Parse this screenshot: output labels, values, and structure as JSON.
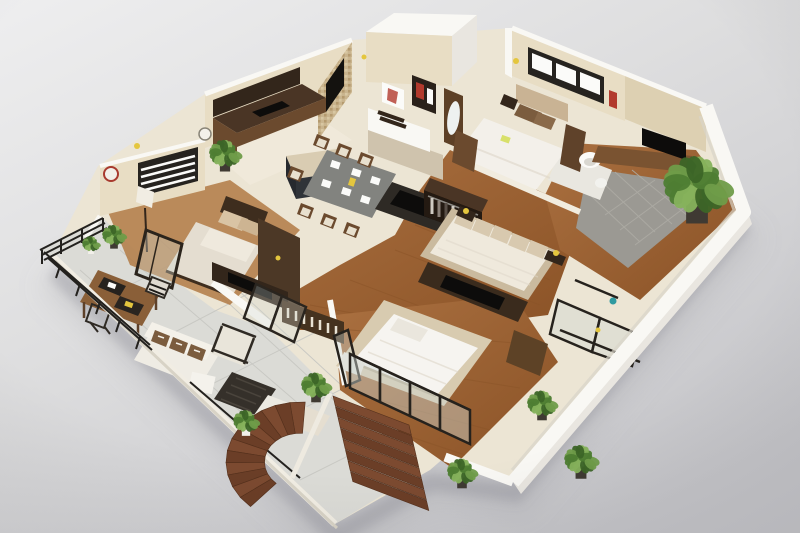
{
  "meta": {
    "title": "3D isometric floor plan rendering",
    "description": "Photorealistic 3D cutaway floor plan of a furnished multi-bedroom apartment viewed from above at an angle, on a neutral gray studio background"
  },
  "palette": {
    "bgLight": "#ededef",
    "bgMid": "#dcdcdf",
    "bgDark": "#c6c6ca",
    "groundShadow": "#8e8e96",
    "wallWhite": "#f9f8f4",
    "wallWhiteFace": "#e9e6e0",
    "wallCream": "#e8ddc4",
    "wallCreamDark": "#ddd0b2",
    "floorCream": "#ece5d4",
    "floorKitchen": "#f0e9da",
    "tileLine": "#d6cfbf",
    "balconyTile": "#dbdbd6",
    "balconyTileLine": "#c7c7c2",
    "grayTile": "#9b9993",
    "grayTileLine": "#adaba4",
    "wood": "#9c6434",
    "woodLight": "#b27a44",
    "woodDark": "#7c4a26",
    "woodPlank": "#8a5428",
    "stairWoodA": "#7c4a30",
    "stairWoodB": "#6b3e27",
    "stairEdge": "#54301c",
    "furnDark": "#4a3525",
    "furnDarker": "#33261b",
    "furnBrown": "#6b4a2e",
    "furnMidBrown": "#8a5f38",
    "counterTop": "#d9ccb2",
    "islandBase": "#2f3338",
    "black": "#14120f",
    "screenBlack": "#0d0c0b",
    "bedding": "#f3f0ea",
    "beddingShade": "#ddd6c8",
    "mattress": "#efe9dc",
    "upholstery": "#d8c9af",
    "upholsteryDark": "#c4b296",
    "pillowBrown": "#7b5c3e",
    "pillowTan": "#d9c4a4",
    "rug": "#d8cbb0",
    "rugDark": "#2e2a25",
    "glass": "#cfd6d2",
    "frame": "#26221d",
    "metal": "#8d8a84",
    "green1": "#6f9c49",
    "green2": "#4e7d33",
    "green3": "#86b25c",
    "green4": "#3c6527",
    "potDark": "#3f3a33",
    "potWhite": "#f2f0ea",
    "accentYellow": "#e4c63e",
    "accentRed": "#b23a2d",
    "accentTeal": "#2f9aa0",
    "mosaic1": "#c9b48e",
    "mosaic2": "#b49a6e",
    "mosaic3": "#d8c7a2",
    "windowFrame": "#26231f",
    "paneWhite": "#fbfbf9"
  },
  "scene": {
    "rooms": [
      {
        "id": "kitchen",
        "floor": "cream tile",
        "furniture": [
          "dark wood cabinets",
          "black cooktop",
          "mosaic accent wall",
          "wall tv"
        ]
      },
      {
        "id": "entry-foyer",
        "floor": "cream tile",
        "furniture": [
          "white raised walls",
          "art frames",
          "white console with books",
          "brown pillar with oval mirror"
        ]
      },
      {
        "id": "bedroom-2",
        "floor": "cream tile",
        "furniture": [
          "double bed white duvet",
          "black framed window",
          "bedside table",
          "brown dresser",
          "red wall art"
        ]
      },
      {
        "id": "bathroom",
        "floor": "light tile",
        "furniture": [
          "round white sink",
          "toilet"
        ]
      },
      {
        "id": "terrace-right",
        "floor": "gray tile with wood border",
        "furniture": [
          "tv on wood sideboard",
          "large potted plant",
          "leaning glass fence panels"
        ]
      },
      {
        "id": "dining-area",
        "floor": "cream tile",
        "furniture": [
          "dining table with white place settings",
          "eight wood chairs",
          "kitchen island beige top dark base"
        ]
      },
      {
        "id": "master-bedroom",
        "floor": "wood plank",
        "furniture": [
          "upholstered bed with cushions",
          "dark tv media unit",
          "open wardrobe with hanging clothes",
          "open door leaf"
        ]
      },
      {
        "id": "bedroom-1",
        "floor": "wood plank",
        "furniture": [
          "double bed beige pillows",
          "window with blinds",
          "floor lamp",
          "decorative wall plates",
          "dark glass door frame"
        ]
      },
      {
        "id": "balcony-left",
        "floor": "large gray tile",
        "furniture": [
          "wood work desk",
          "two dark laptops",
          "wireframe chairs",
          "black metal railing",
          "white planter"
        ]
      },
      {
        "id": "terrace-bottom",
        "floor": "large light tile",
        "furniture": [
          "outdoor sofa with striped pillows",
          "framed armchair",
          "black slatted coffee table",
          "white chaise",
          "planter boxes"
        ]
      },
      {
        "id": "bedroom-3",
        "floor": "wood plank with beige rug",
        "furniture": [
          "double bed white duvet",
          "glass partition walls",
          "brown wardrobe cabinet",
          "white bench"
        ]
      }
    ],
    "plants": [
      {
        "x": 697,
        "y": 182,
        "r": 34,
        "pot": "potDark"
      },
      {
        "x": 225,
        "y": 152,
        "r": 16,
        "pot": "potDark"
      },
      {
        "x": 114,
        "y": 234,
        "r": 12,
        "pot": "potDark"
      },
      {
        "x": 91,
        "y": 243,
        "r": 9,
        "pot": "potWhite"
      },
      {
        "x": 316,
        "y": 384,
        "r": 15,
        "pot": "potDark"
      },
      {
        "x": 246,
        "y": 420,
        "r": 13,
        "pot": "potWhite"
      },
      {
        "x": 542,
        "y": 402,
        "r": 15,
        "pot": "potDark"
      },
      {
        "x": 581,
        "y": 458,
        "r": 17,
        "pot": "potDark"
      },
      {
        "x": 462,
        "y": 470,
        "r": 15,
        "pot": "potDark"
      }
    ],
    "stairs": {
      "straight": {
        "x": 333,
        "y": 396,
        "tx": 76,
        "ty": 29,
        "sx": 2.5,
        "sy": 10.8,
        "count": 8
      },
      "curved": {
        "cx": 300,
        "cy": 462,
        "rx": 74,
        "ry": 60,
        "inner": 0.48,
        "startDeg": -86,
        "sweepDeg": -142,
        "count": 12
      }
    },
    "accents": [
      {
        "x": 516,
        "y": 61,
        "r": 3,
        "color": "accentYellow"
      },
      {
        "x": 466,
        "y": 211,
        "r": 3,
        "color": "accentYellow"
      },
      {
        "x": 556,
        "y": 253,
        "r": 3,
        "color": "accentYellow"
      },
      {
        "x": 137,
        "y": 146,
        "r": 3,
        "color": "accentYellow"
      },
      {
        "x": 598,
        "y": 330,
        "r": 2.5,
        "color": "accentYellow"
      },
      {
        "x": 364,
        "y": 57,
        "r": 2.5,
        "color": "accentYellow"
      },
      {
        "x": 613,
        "y": 301,
        "r": 3.5,
        "color": "accentTeal"
      }
    ]
  }
}
